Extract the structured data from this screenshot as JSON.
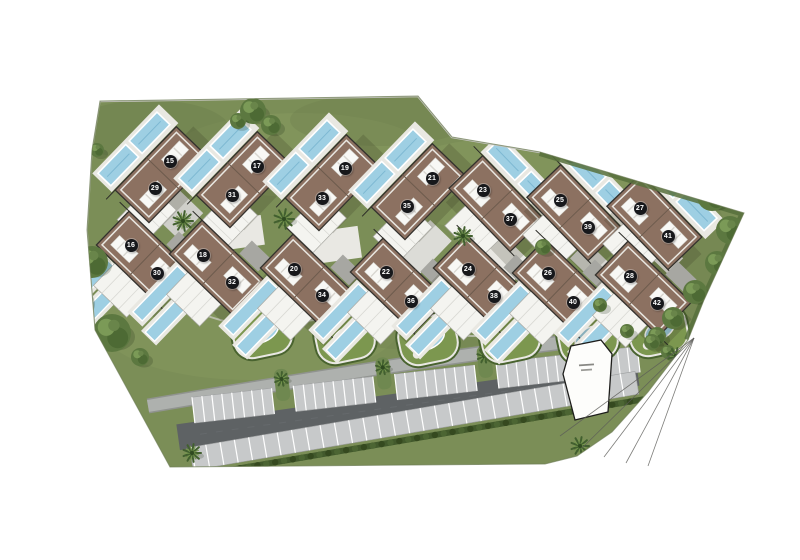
{
  "units": [
    {
      "number": "15",
      "x": 170,
      "y": 161
    },
    {
      "number": "17",
      "x": 257,
      "y": 166
    },
    {
      "number": "19",
      "x": 345,
      "y": 168
    },
    {
      "number": "21",
      "x": 432,
      "y": 178
    },
    {
      "number": "23",
      "x": 483,
      "y": 190
    },
    {
      "number": "25",
      "x": 560,
      "y": 200
    },
    {
      "number": "27",
      "x": 640,
      "y": 208
    },
    {
      "number": "29",
      "x": 155,
      "y": 188
    },
    {
      "number": "31",
      "x": 232,
      "y": 195
    },
    {
      "number": "33",
      "x": 322,
      "y": 198
    },
    {
      "number": "35",
      "x": 407,
      "y": 206
    },
    {
      "number": "37",
      "x": 510,
      "y": 219
    },
    {
      "number": "39",
      "x": 588,
      "y": 227
    },
    {
      "number": "41",
      "x": 668,
      "y": 236
    },
    {
      "number": "16",
      "x": 131,
      "y": 245
    },
    {
      "number": "18",
      "x": 203,
      "y": 255
    },
    {
      "number": "20",
      "x": 294,
      "y": 269
    },
    {
      "number": "22",
      "x": 386,
      "y": 272
    },
    {
      "number": "24",
      "x": 468,
      "y": 269
    },
    {
      "number": "26",
      "x": 548,
      "y": 273
    },
    {
      "number": "28",
      "x": 630,
      "y": 276
    },
    {
      "number": "30",
      "x": 157,
      "y": 273
    },
    {
      "number": "32",
      "x": 232,
      "y": 282
    },
    {
      "number": "34",
      "x": 322,
      "y": 295
    },
    {
      "number": "36",
      "x": 411,
      "y": 301
    },
    {
      "number": "38",
      "x": 494,
      "y": 296
    },
    {
      "number": "40",
      "x": 573,
      "y": 302
    },
    {
      "number": "42",
      "x": 657,
      "y": 303
    }
  ],
  "colors": {
    "background": "#ffffff",
    "grass": "#7b8e57",
    "grass_light": "#87995f",
    "grass_dark": "#6d7f4e",
    "roof": "#8c7161",
    "roof_line": "#33312d",
    "roof_divider": "#6d5b4d",
    "white_roof": "#f4f4f0",
    "white_roof_line": "#a9a9a3",
    "parapet": "#e9e7e1",
    "pool": "#9ecfe3",
    "pool_line": "#7db8d2",
    "deck": "#e9e8e2",
    "road": "#aeb1ae",
    "court_gray": "#cfcfca",
    "court_white": "#e9e8e3",
    "asphalt": "#5e6264",
    "stall": "#c7c9ca",
    "stall_line": "#ffffff",
    "island": "#6f8850",
    "hedge": "#42592c",
    "hedge_dot_a": "#4c6533",
    "hedge_dot_b": "#35491f",
    "tree": "#5c7840",
    "tree_dark": "#4d6a34",
    "tree_light": "#7b9a57",
    "palm": "#42602f",
    "palm_light": "#76964e",
    "wall": "#c6c6c0",
    "boundary": "#6b7a52",
    "survey_line": "#5c5c58",
    "marker_bg": "#17181b",
    "marker_text": "#ffffff",
    "future_plot_fill": "#fdfdfb",
    "future_plot_line": "#1d1d1b"
  }
}
